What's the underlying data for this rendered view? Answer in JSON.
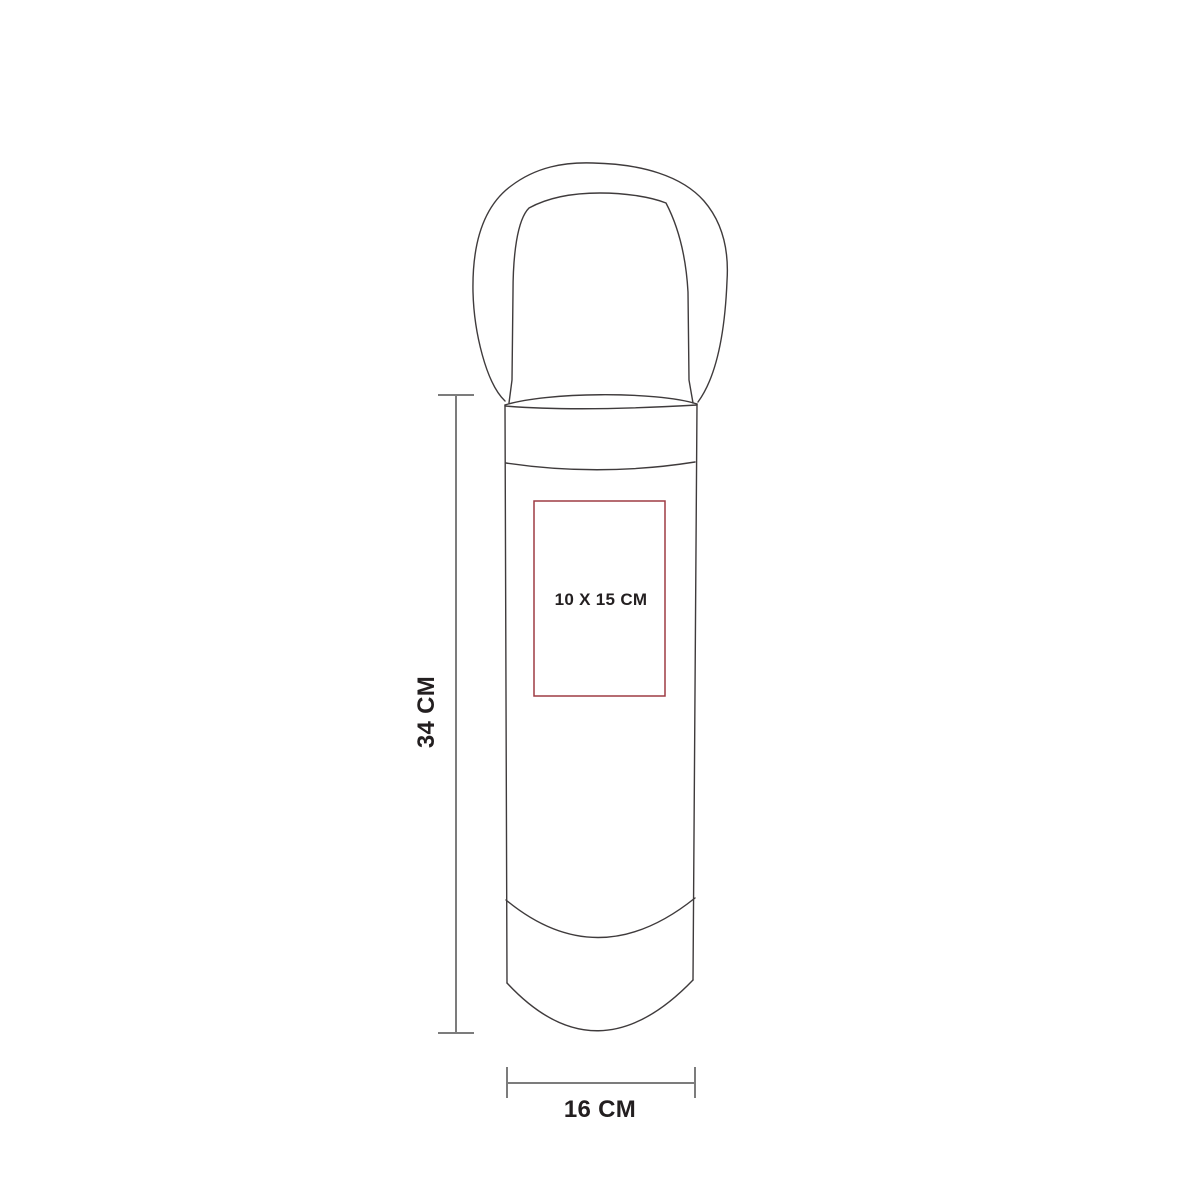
{
  "figure": {
    "background_color": "#ffffff",
    "outline_color": "#3f3b3c",
    "dimension_line_color": "#7c7c7c",
    "text_color": "#231f20",
    "labels": {
      "height": "34 CM",
      "width": "16 CM"
    },
    "print_area": {
      "label": "10 X 15 CM",
      "border_color": "#9e3b43"
    }
  }
}
